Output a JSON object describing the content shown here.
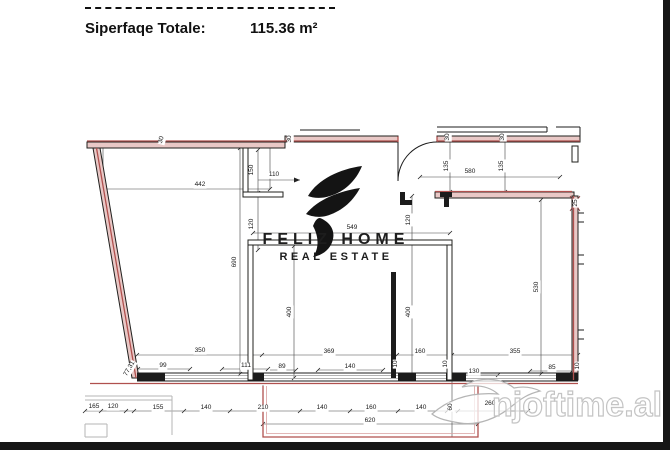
{
  "header": {
    "label": "Siperfaqe Totale:",
    "value": "115.36 m²"
  },
  "logo": {
    "name": "FELIZ HOME",
    "tagline": "REAL ESTATE"
  },
  "watermark": {
    "site": "njoftime.al"
  },
  "plan": {
    "wall_color": "#1c1c1c",
    "accent_red": "#b0504e",
    "dimensions": [
      {
        "value": "442",
        "x": 200,
        "y": 185
      },
      {
        "value": "150",
        "x": 252,
        "y": 170,
        "rot": -90
      },
      {
        "value": "110",
        "x": 274,
        "y": 175
      },
      {
        "value": "120",
        "x": 252,
        "y": 224,
        "rot": -90
      },
      {
        "value": "690",
        "x": 235,
        "y": 262,
        "rot": -90
      },
      {
        "value": "549",
        "x": 352,
        "y": 228
      },
      {
        "value": "120",
        "x": 409,
        "y": 220,
        "rot": -90
      },
      {
        "value": "400",
        "x": 290,
        "y": 312,
        "rot": -90
      },
      {
        "value": "400",
        "x": 409,
        "y": 312,
        "rot": -90
      },
      {
        "value": "530",
        "x": 537,
        "y": 287,
        "rot": -90
      },
      {
        "value": "580",
        "x": 470,
        "y": 172
      },
      {
        "value": "135",
        "x": 447,
        "y": 166,
        "rot": -90
      },
      {
        "value": "135",
        "x": 502,
        "y": 166,
        "rot": -90
      },
      {
        "value": "30",
        "x": 290,
        "y": 139,
        "rot": -90
      },
      {
        "value": "30",
        "x": 448,
        "y": 137,
        "rot": -90
      },
      {
        "value": "30",
        "x": 503,
        "y": 137,
        "rot": -90
      },
      {
        "value": "30",
        "x": 162,
        "y": 140,
        "rot": -75
      },
      {
        "value": "25",
        "x": 576,
        "y": 203,
        "rot": -90
      },
      {
        "value": "350",
        "x": 200,
        "y": 351
      },
      {
        "value": "369",
        "x": 329,
        "y": 352
      },
      {
        "value": "160",
        "x": 420,
        "y": 352
      },
      {
        "value": "355",
        "x": 515,
        "y": 352
      },
      {
        "value": "99",
        "x": 163,
        "y": 366
      },
      {
        "value": "111",
        "x": 246,
        "y": 366
      },
      {
        "value": "89",
        "x": 282,
        "y": 367
      },
      {
        "value": "140",
        "x": 350,
        "y": 367
      },
      {
        "value": "10",
        "x": 396,
        "y": 364,
        "rot": -90
      },
      {
        "value": "10",
        "x": 446,
        "y": 364,
        "rot": -90
      },
      {
        "value": "130",
        "x": 474,
        "y": 372
      },
      {
        "value": "85",
        "x": 552,
        "y": 368
      },
      {
        "value": "10",
        "x": 578,
        "y": 366,
        "rot": -90
      },
      {
        "value": "77,31",
        "x": 130,
        "y": 369,
        "rot": -60
      },
      {
        "value": "165",
        "x": 94,
        "y": 407
      },
      {
        "value": "120",
        "x": 113,
        "y": 407
      },
      {
        "value": "155",
        "x": 158,
        "y": 408
      },
      {
        "value": "140",
        "x": 206,
        "y": 408
      },
      {
        "value": "210",
        "x": 263,
        "y": 408
      },
      {
        "value": "140",
        "x": 322,
        "y": 408
      },
      {
        "value": "160",
        "x": 371,
        "y": 408
      },
      {
        "value": "140",
        "x": 421,
        "y": 408
      },
      {
        "value": "60",
        "x": 451,
        "y": 407,
        "rot": -90
      },
      {
        "value": "260",
        "x": 490,
        "y": 404
      },
      {
        "value": "620",
        "x": 370,
        "y": 421
      }
    ]
  }
}
